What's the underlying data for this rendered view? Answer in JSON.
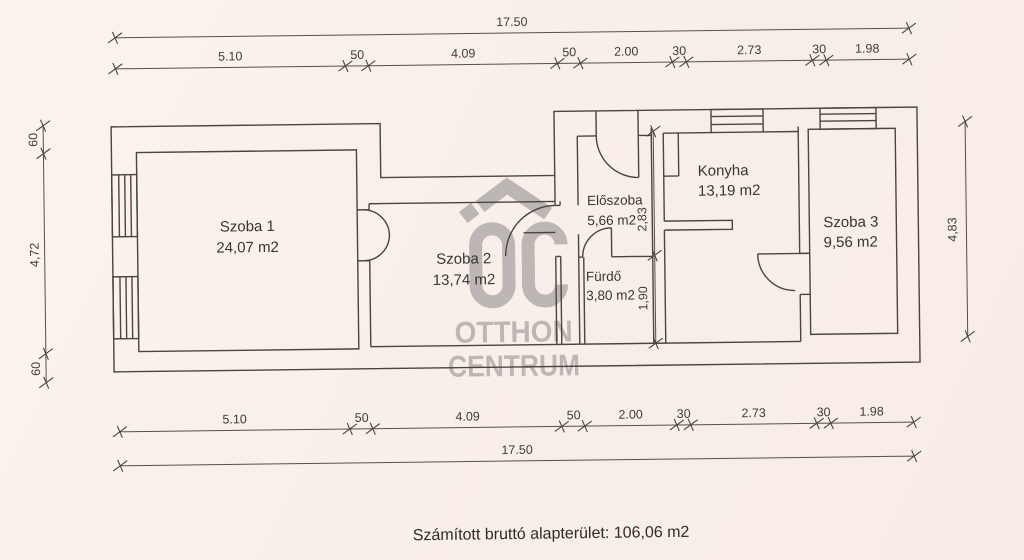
{
  "rooms": {
    "szoba1": {
      "name": "Szoba 1",
      "area": "24,07 m2"
    },
    "szoba2": {
      "name": "Szoba 2",
      "area": "13,74 m2"
    },
    "eloszoba": {
      "name": "Előszoba",
      "area": "5,66 m2"
    },
    "furdo": {
      "name": "Fürdő",
      "area": "3,80 m2"
    },
    "konyha": {
      "name": "Konyha",
      "area": "13,19 m2"
    },
    "szoba3": {
      "name": "Szoba 3",
      "area": "9,56 m2"
    }
  },
  "dimensions": {
    "total_width": "17.50",
    "bottom_total": "17.50",
    "top_segments": [
      "5.10",
      "50",
      "4.09",
      "50",
      "2.00",
      "30",
      "2.73",
      "30",
      "1.98"
    ],
    "bottom_segments": [
      "5.10",
      "50",
      "4.09",
      "50",
      "2.00",
      "30",
      "2.73",
      "30",
      "1.98"
    ],
    "left": {
      "top": "60",
      "middle": "4,72",
      "bottom": "60"
    },
    "right": "4,83",
    "interior_upper": "2,83",
    "interior_lower": "1,90"
  },
  "watermark": {
    "line1": "OTTHON",
    "line2": "CENTRUM"
  },
  "footer": {
    "label": "Számított bruttó alapterület: 106,06 m2"
  },
  "colors": {
    "background": "#f9efe9",
    "line": "#4a453e",
    "watermark": "#b6b2af",
    "text": "#38342e"
  }
}
